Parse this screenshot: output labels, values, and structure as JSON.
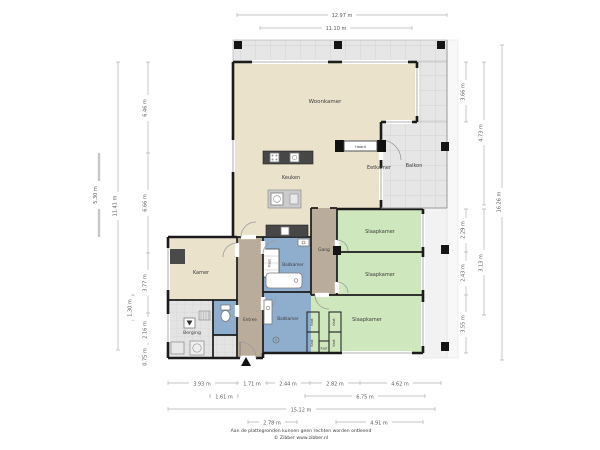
{
  "plan_title": "Appartement plattegrond",
  "rooms": {
    "woonkamer": "Woonkamer",
    "keuken": "Keuken",
    "eetkamer": "Eetkamer",
    "balkon": "Balkon",
    "kamer": "Kamer",
    "berging": "Berging",
    "entree": "Entree",
    "gang": "Gang",
    "badkamer": "Badkamer",
    "slaapkamer": "Slaapkamer",
    "kast": "Kast",
    "haard": "Haard"
  },
  "dimensions": {
    "top": [
      "12.97 m",
      "11.10 m"
    ],
    "left": [
      "5.30 m",
      "11.41 m",
      "6.46 m",
      "6.66 m",
      "3.77 m",
      "2.16 m",
      "0.75 m",
      "1.30 m"
    ],
    "right": [
      "3.66 m",
      "2.29 m",
      "2.43 m",
      "3.55 m",
      "4.73 m",
      "3.13 m",
      "16.26 m"
    ],
    "bottom_row1": [
      "3.93 m",
      "1.71 m",
      "2.44 m",
      "2.82 m",
      "4.62 m"
    ],
    "bottom_row2": [
      "1.61 m",
      "6.75 m"
    ],
    "bottom_row3": [
      "15.12 m"
    ],
    "bottom_row4": [
      "2.78 m",
      "4.91 m"
    ]
  },
  "disclaimer": {
    "line1": "Aan de plattegronden kunnen geen rechten worden ontleend",
    "line2": "© Zibber www.zibber.nl"
  },
  "colors": {
    "living": "#eae2cb",
    "bedroom": "#cfe7bd",
    "bathroom": "#8fadcd",
    "hallway": "#b9ac9a",
    "tile": "#e6e6e6",
    "wall": "#1b1b1b"
  }
}
